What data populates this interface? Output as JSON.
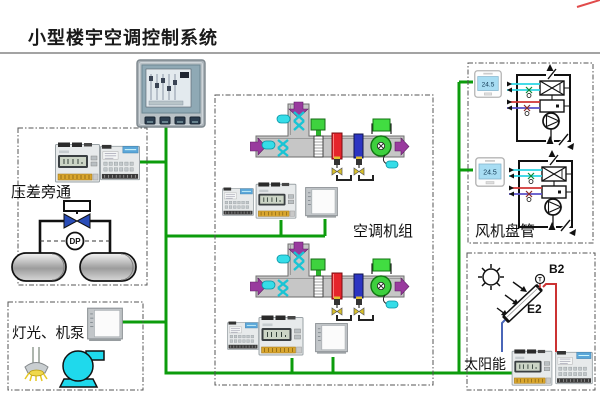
{
  "title": "小型楼宇空调控制系统",
  "sections": {
    "pressure_bypass": {
      "label": "压差旁通",
      "sensor_label": "DP"
    },
    "lighting_pump": {
      "label": "灯光、机泵"
    },
    "ahu": {
      "label": "空调机组"
    },
    "fan_coil": {
      "label": "风机盘管",
      "thermostat_reading": "24.5"
    },
    "solar": {
      "label": "太阳能",
      "sensor_label": "B2",
      "collector_label": "E2",
      "sensor_symbol": "T"
    }
  },
  "colors": {
    "network_green": "#0c9c0c",
    "arrow_purple": "#993a9e",
    "coil_red": "#e5242b",
    "coil_blue": "#2c35c2",
    "fan_green": "#3ecf3e",
    "sensor_cyan": "#35dde8",
    "pump_cyan": "#1fd9ec",
    "pipe_red": "#cc3333",
    "pipe_blue": "#4a66b8",
    "valve_navy": "#2a4db8",
    "dashed_border": "#555555",
    "title_underline": "#a3a3a3",
    "corner_mark_red": "#e14b4b"
  },
  "icons": {
    "touch_panel": "hmi-touch-panel",
    "controller": "din-rail-controller",
    "io_module": "io-module",
    "wall_panel": "wall-mounted-panel",
    "thermostat": "room-thermostat",
    "sun": "sun-icon",
    "lamp": "lamp-icon",
    "pump": "pump-icon"
  }
}
